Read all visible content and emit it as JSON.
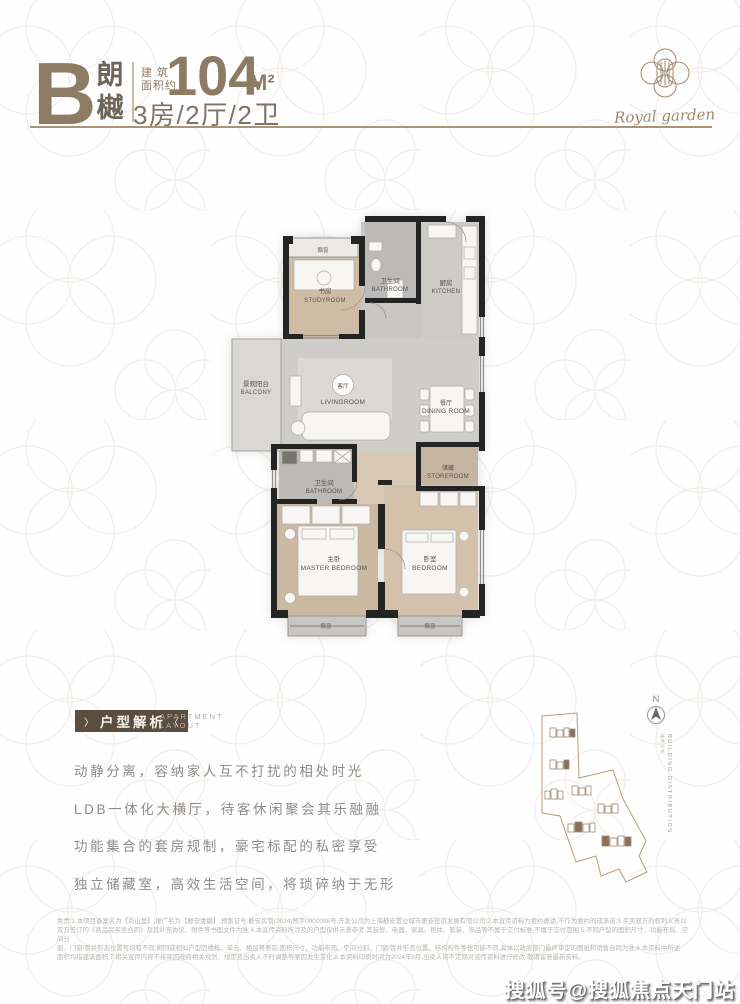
{
  "header": {
    "type_letter": "B",
    "name_top": "朗",
    "name_bottom": "樾",
    "area_label": "建 筑\n面积约",
    "area_value": "104",
    "area_unit": "M²",
    "spec": "3房/2厅/2卫"
  },
  "logo": {
    "script": "Royal garden"
  },
  "floorplan": {
    "bay_window_label": "飘窗",
    "rooms": {
      "study": {
        "zh": "书房",
        "en": "STUDYROOM"
      },
      "bathroom1": {
        "zh": "卫生间",
        "en": "BATHROOM"
      },
      "kitchen": {
        "zh": "厨房",
        "en": "KITCHEN"
      },
      "balcony": {
        "zh": "景观阳台",
        "en": "BALCONY"
      },
      "living": {
        "zh": "客厅",
        "en": "LIVINGROOM"
      },
      "dining": {
        "zh": "餐厅",
        "en": "DINING ROOM"
      },
      "storeroom": {
        "zh": "储藏",
        "en": "STOREROOM"
      },
      "bathroom2": {
        "zh": "卫生间",
        "en": "BATHROOM"
      },
      "master": {
        "zh": "主卧",
        "en": "MASTER BEDROOM"
      },
      "bedroom": {
        "zh": "卧室",
        "en": "BEDROOM"
      }
    }
  },
  "analysis": {
    "badge": "户型解析",
    "deco_left": "〉",
    "deco_right": "〈",
    "subtitle_line1": "APARTMENT",
    "subtitle_line2": "LAYOUT",
    "lines": [
      "动静分离，容纳家人互不打扰的相处时光",
      "LDB一体化大横厅，待客休闲聚会其乐融融",
      "功能集合的套房规制，豪宅标配的私密享受",
      "独立储藏室，高效生活空间，将琐碎纳于无形"
    ]
  },
  "siteplan": {
    "north_label": "N",
    "caption_en": "BUILDING DISTRIBUTION",
    "caption_zh": "楼栋分布"
  },
  "disclaimer": {
    "lines": [
      "免责:1.本项目备案名为【岚山里】,推广名为【静安壹樾】,预售证号:静安房管(2024)预字0000098号,开发公司为上海静安置业城市更新投资发展有限公司;2.本宣传资料为要约邀请,不作为要约的成承诺;3.买卖双方的权利义务以",
      "双方签订的《商品房买卖合同》及其补充协议、附件等书面文件为准;4.本宣传资料所涉及的户型仅供示意参考,其装修、电器、家具、柜体、软装、饰品等不属于交付标准,不属于交付范围;5.不同户型的面积尺寸、功能布局、空间分",
      "割、门窗/管井形态位置等均有不同;相同或相似户型因楼栋、单元、楼层等差别,面积尺寸、功能布局、空间分割、门窗/管井形态位置、结构构件等也可能不同,具体以政府部门最终审定的图纸和销售合同为准;6.本资料中所述",
      "面积均指建筑面积;7.相关宣传内容不排除因政府相关规划、规定及出卖人不时调整等原因发生变化;8.本资料印刷时间为2024年9月,出卖人将不定期对宣传资料进行修改,敬请留意最新资料。"
    ]
  },
  "watermark": "搜狐号@搜狐焦点天门站",
  "colors": {
    "brand_brown": "#8d7b64",
    "badge_brown": "#5c4e3f",
    "wall_black": "#242424",
    "wood_floor": "#cfbca5",
    "gray_floor": "#cfcdca",
    "site_outline": "#b89c7e",
    "building_highlight": "#8a7158"
  }
}
